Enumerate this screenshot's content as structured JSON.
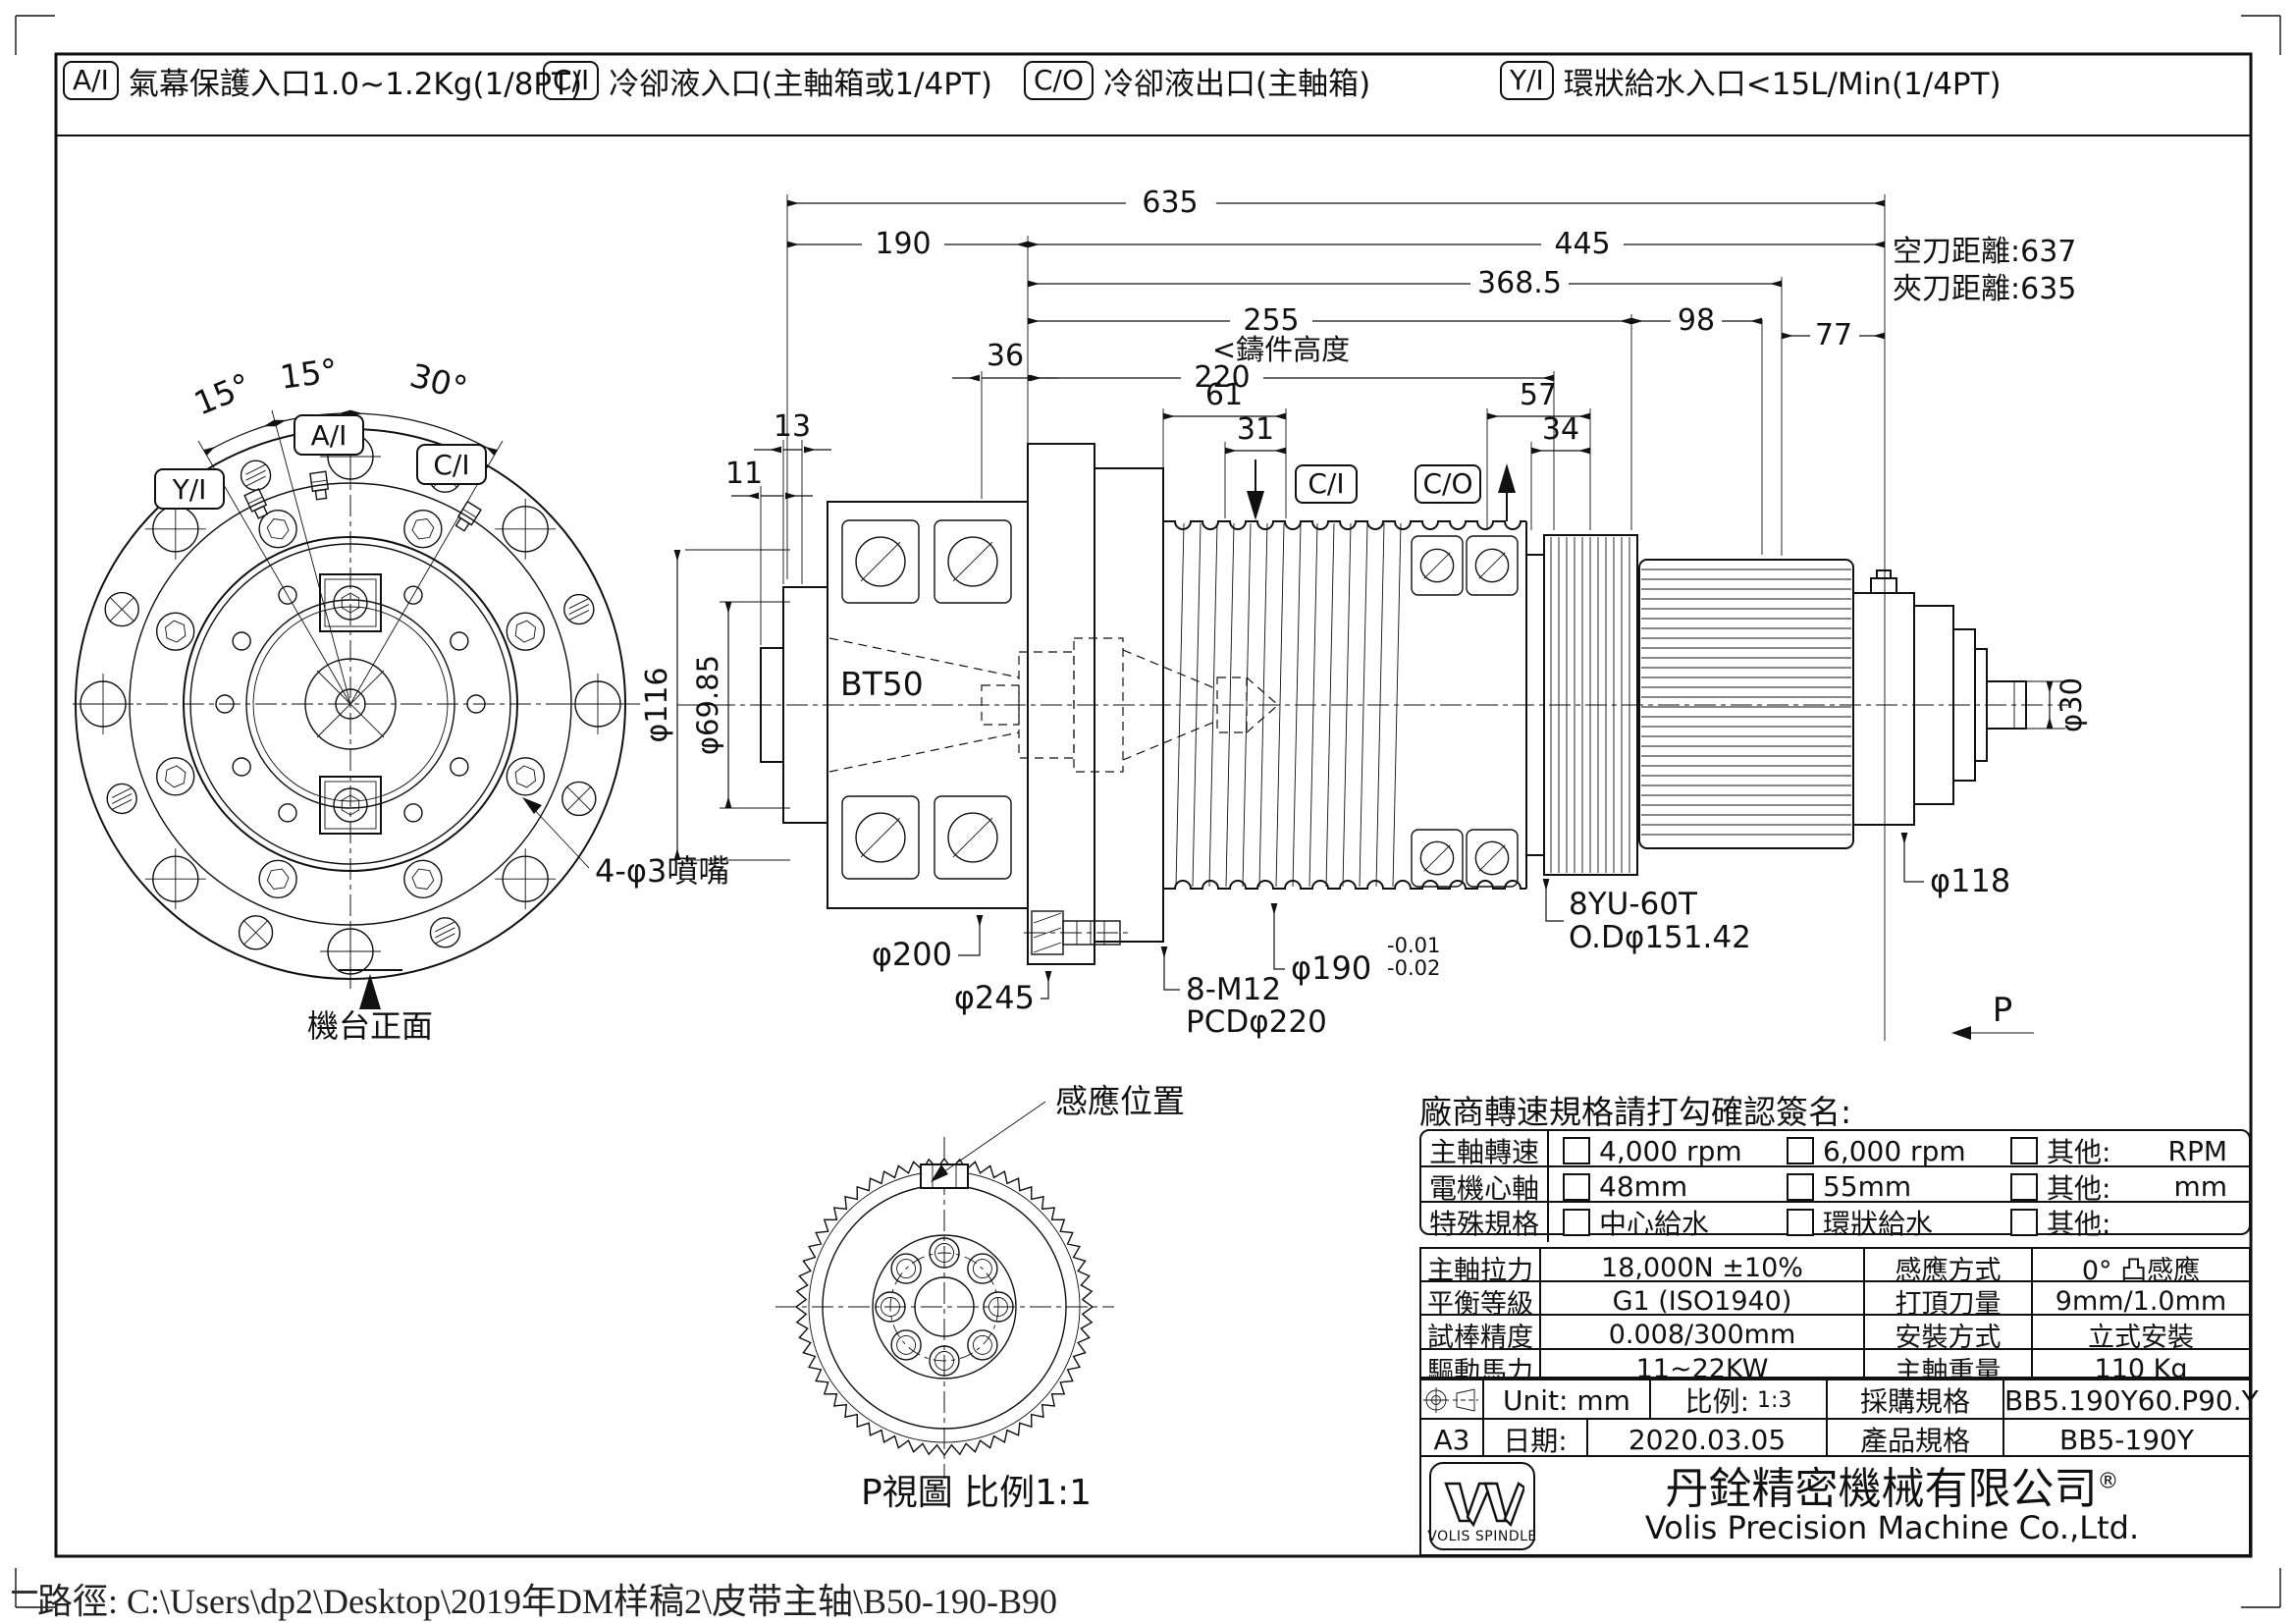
{
  "ports": [
    {
      "tag": "A/I",
      "desc": "氣幕保護入口1.0~1.2Kg(1/8PT)"
    },
    {
      "tag": "C/I",
      "desc": "冷卻液入口(主軸箱或1/4PT)"
    },
    {
      "tag": "C/O",
      "desc": "冷卻液出口(主軸箱)"
    },
    {
      "tag": "Y/I",
      "desc": "環狀給水入口<15L/Min(1/4PT)"
    }
  ],
  "fv": {
    "a15a": "15°",
    "a15b": "15°",
    "a30": "30°",
    "yi": "Y/I",
    "ai": "A/I",
    "ci": "C/I",
    "nozzle": "4-φ3噴嘴",
    "front": "機台正面"
  },
  "sv": {
    "d635": "635",
    "d190": "190",
    "d445": "445",
    "d3685": "368.5",
    "d255": "255",
    "d98": "98",
    "d77": "77",
    "d220": "220",
    "casting": "<鑄件高度",
    "d36": "36",
    "d13": "13",
    "d11": "11",
    "d61": "61",
    "d31": "31",
    "d57": "57",
    "d34": "34",
    "ci": "C/I",
    "co": "C/O",
    "air": "空刀距離:637",
    "clamp": "夾刀距離:635",
    "bt50": "BT50",
    "d116": "φ116",
    "d6985": "φ69.85",
    "d200": "φ200",
    "d245": "φ245",
    "m12a": "8-M12",
    "m12b": "PCDφ220",
    "d190t": "φ190",
    "tolu": "-0.01",
    "told": "-0.02",
    "gear1": "8YU-60T",
    "gear2": "O.Dφ151.42",
    "d118": "φ118",
    "d30": "φ30",
    "p": "P"
  },
  "gv": {
    "sensor": "感應位置",
    "caption": "P視圖 比例1:1"
  },
  "order": {
    "title": "廠商轉速規格請打勾確認簽名:",
    "rows": [
      {
        "label": "主軸轉速",
        "opt1": "4,000 rpm",
        "opt2": "6,000 rpm",
        "other": "其他:",
        "unit": "RPM"
      },
      {
        "label": "電機心軸",
        "opt1": "48mm",
        "opt2": "55mm",
        "other": "其他:",
        "unit": "mm"
      },
      {
        "label": "特殊規格",
        "opt1": "中心給水",
        "opt2": "環狀給水",
        "other": "其他:",
        "unit": ""
      }
    ]
  },
  "spec": {
    "rows": [
      {
        "l1": "主軸拉力",
        "v1": "18,000N ±10%",
        "l2": "感應方式",
        "v2": "0° 凸感應"
      },
      {
        "l1": "平衡等級",
        "v1": "G1 (ISO1940)",
        "l2": "打頂刀量",
        "v2": "9mm/1.0mm"
      },
      {
        "l1": "試棒精度",
        "v1": "0.008/300mm",
        "l2": "安裝方式",
        "v2": "立式安裝"
      },
      {
        "l1": "驅動馬力",
        "v1": "11~22KW",
        "l2": "主軸重量",
        "v2": "110 Kg"
      }
    ]
  },
  "tb": {
    "unit": "Unit: mm",
    "scale_label": "比例:",
    "scale_value": "1:3",
    "purchase_label": "採購規格",
    "purchase_value": "BB5.190Y60.P90.Y",
    "size": "A3",
    "date_label": "日期:",
    "date_value": "2020.03.05",
    "product_label": "產品規格",
    "product_value": "BB5-190Y",
    "logo_text": "VOLIS SPINDLE",
    "company_cn": "丹銓精密機械有限公司",
    "reg": "®",
    "company_en": "Volis Precision Machine Co.,Ltd."
  },
  "footer": {
    "path": "路徑: C:\\Users\\dp2\\Desktop\\2019年DM样稿2\\皮带主轴\\B50-190-B90"
  }
}
